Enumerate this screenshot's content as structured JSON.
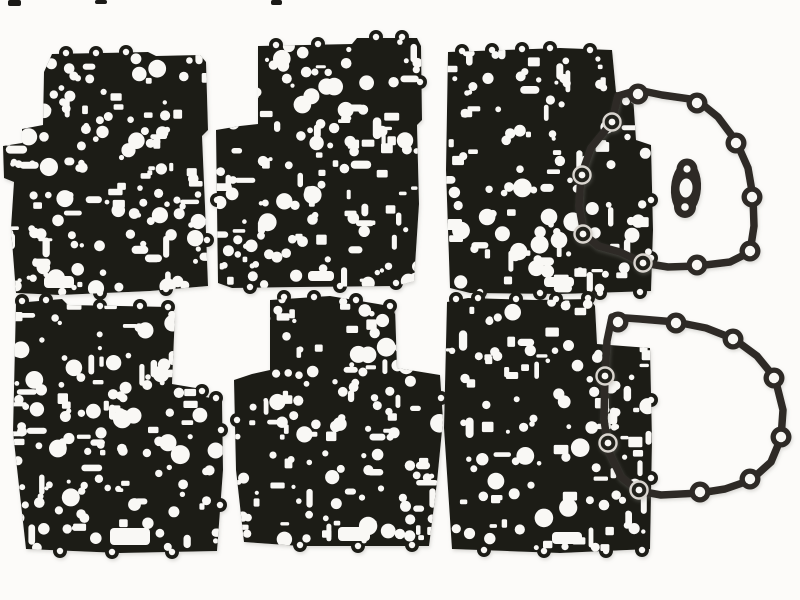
{
  "scene": {
    "background": "#fcfbf9",
    "plate_color": "#1b1a18",
    "hole_color": "#f9f8f5",
    "gasket_color": "#2e2b27",
    "ring_edge_color": "#d9d5cf",
    "ring_center_color": "#24211e",
    "plates": [
      {
        "name": "separator-plate-top-left",
        "outline": [
          [
            52,
            54
          ],
          [
            148,
            52
          ],
          [
            156,
            56
          ],
          [
            200,
            55
          ],
          [
            206,
            62
          ],
          [
            208,
            130
          ],
          [
            202,
            136
          ],
          [
            205,
            206
          ],
          [
            208,
            286
          ],
          [
            150,
            291
          ],
          [
            60,
            295
          ],
          [
            16,
            293
          ],
          [
            11,
            228
          ],
          [
            14,
            182
          ],
          [
            4,
            178
          ],
          [
            3,
            146
          ],
          [
            22,
            143
          ],
          [
            22,
            129
          ],
          [
            43,
            125
          ],
          [
            44,
            72
          ],
          [
            52,
            54
          ]
        ],
        "ears": [
          [
            66,
            53
          ],
          [
            96,
            53
          ],
          [
            126,
            52
          ],
          [
            14,
            162
          ],
          [
            100,
            293
          ],
          [
            166,
            289
          ],
          [
            207,
            240
          ]
        ],
        "slot": [
          44,
          276,
          30,
          12
        ],
        "hole_count": 150
      },
      {
        "name": "separator-plate-top-middle",
        "outline": [
          [
            258,
            46
          ],
          [
            352,
            44
          ],
          [
            357,
            38
          ],
          [
            417,
            38
          ],
          [
            421,
            46
          ],
          [
            422,
            120
          ],
          [
            417,
            125
          ],
          [
            419,
            204
          ],
          [
            414,
            281
          ],
          [
            396,
            286
          ],
          [
            300,
            287
          ],
          [
            232,
            288
          ],
          [
            218,
            283
          ],
          [
            216,
            130
          ],
          [
            240,
            126
          ],
          [
            258,
            124
          ],
          [
            258,
            46
          ]
        ],
        "ears": [
          [
            276,
            45
          ],
          [
            318,
            44
          ],
          [
            376,
            37
          ],
          [
            402,
            37
          ],
          [
            420,
            82
          ],
          [
            250,
            287
          ],
          [
            340,
            286
          ],
          [
            396,
            283
          ],
          [
            217,
            200
          ]
        ],
        "slot": [
          308,
          271,
          26,
          10
        ],
        "hole_count": 150
      },
      {
        "name": "separator-plate-top-right",
        "outline": [
          [
            448,
            52
          ],
          [
            560,
            48
          ],
          [
            612,
            50
          ],
          [
            616,
            92
          ],
          [
            633,
            95
          ],
          [
            636,
            140
          ],
          [
            651,
            145
          ],
          [
            653,
            230
          ],
          [
            651,
            291
          ],
          [
            560,
            294
          ],
          [
            470,
            293
          ],
          [
            450,
            288
          ],
          [
            446,
            170
          ],
          [
            448,
            52
          ]
        ],
        "ears": [
          [
            462,
            51
          ],
          [
            492,
            50
          ],
          [
            522,
            49
          ],
          [
            550,
            48
          ],
          [
            590,
            50
          ],
          [
            651,
            200
          ],
          [
            651,
            258
          ],
          [
            480,
            292
          ],
          [
            540,
            293
          ],
          [
            600,
            293
          ],
          [
            640,
            292
          ]
        ],
        "slot": [
          544,
          277,
          30,
          10
        ],
        "hole_count": 130
      },
      {
        "name": "separator-plate-bottom-left",
        "outline": [
          [
            16,
            303
          ],
          [
            62,
            299
          ],
          [
            68,
            305
          ],
          [
            170,
            307
          ],
          [
            175,
            313
          ],
          [
            172,
            384
          ],
          [
            196,
            388
          ],
          [
            200,
            396
          ],
          [
            222,
            400
          ],
          [
            223,
            470
          ],
          [
            217,
            551
          ],
          [
            120,
            553
          ],
          [
            26,
            549
          ],
          [
            13,
            432
          ],
          [
            16,
            303
          ]
        ],
        "ears": [
          [
            22,
            301
          ],
          [
            46,
            300
          ],
          [
            100,
            306
          ],
          [
            140,
            306
          ],
          [
            168,
            307
          ],
          [
            202,
            391
          ],
          [
            216,
            398
          ],
          [
            221,
            430
          ],
          [
            220,
            505
          ],
          [
            60,
            551
          ],
          [
            112,
            552
          ],
          [
            172,
            552
          ]
        ],
        "slot": [
          110,
          528,
          40,
          17
        ],
        "hole_count": 150
      },
      {
        "name": "separator-plate-bottom-middle",
        "outline": [
          [
            270,
            300
          ],
          [
            330,
            296
          ],
          [
            378,
            304
          ],
          [
            395,
            307
          ],
          [
            397,
            368
          ],
          [
            440,
            375
          ],
          [
            443,
            420
          ],
          [
            437,
            482
          ],
          [
            429,
            546
          ],
          [
            300,
            546
          ],
          [
            244,
            542
          ],
          [
            236,
            470
          ],
          [
            234,
            380
          ],
          [
            252,
            374
          ],
          [
            270,
            370
          ],
          [
            270,
            300
          ]
        ],
        "ears": [
          [
            284,
            297
          ],
          [
            314,
            297
          ],
          [
            356,
            300
          ],
          [
            390,
            306
          ],
          [
            441,
            398
          ],
          [
            300,
            545
          ],
          [
            358,
            546
          ],
          [
            412,
            545
          ],
          [
            237,
            420
          ]
        ],
        "slot": [
          338,
          527,
          32,
          14
        ],
        "hole_count": 150
      },
      {
        "name": "separator-plate-bottom-right",
        "outline": [
          [
            447,
            302
          ],
          [
            468,
            298
          ],
          [
            536,
            300
          ],
          [
            590,
            299
          ],
          [
            595,
            306
          ],
          [
            597,
            344
          ],
          [
            650,
            348
          ],
          [
            652,
            440
          ],
          [
            650,
            549
          ],
          [
            560,
            553
          ],
          [
            452,
            549
          ],
          [
            444,
            428
          ],
          [
            447,
            302
          ]
        ],
        "ears": [
          [
            456,
            299
          ],
          [
            478,
            298
          ],
          [
            516,
            299
          ],
          [
            556,
            299
          ],
          [
            588,
            298
          ],
          [
            651,
            400
          ],
          [
            651,
            478
          ],
          [
            484,
            550
          ],
          [
            544,
            551
          ],
          [
            606,
            551
          ],
          [
            642,
            550
          ]
        ],
        "slot": [
          552,
          532,
          30,
          12
        ],
        "hole_count": 130
      }
    ],
    "gaskets": [
      {
        "name": "case-cover-gasket-top-right",
        "stroke": 7.5,
        "loop": [
          [
            618,
            96
          ],
          [
            638,
            90
          ],
          [
            662,
            95
          ],
          [
            697,
            100
          ],
          [
            718,
            117
          ],
          [
            736,
            141
          ],
          [
            748,
            168
          ],
          [
            753,
            197
          ],
          [
            754,
            226
          ],
          [
            750,
            252
          ],
          [
            730,
            262
          ],
          [
            697,
            266
          ],
          [
            668,
            267
          ],
          [
            643,
            263
          ],
          [
            620,
            252
          ],
          [
            598,
            246
          ],
          [
            584,
            234
          ],
          [
            579,
            206
          ],
          [
            581,
            176
          ],
          [
            591,
            148
          ],
          [
            612,
            122
          ],
          [
            618,
            96
          ]
        ],
        "bolt_holes": [
          {
            "x": 638,
            "y": 94,
            "style": "solid"
          },
          {
            "x": 697,
            "y": 103,
            "style": "solid"
          },
          {
            "x": 736,
            "y": 143,
            "style": "solid"
          },
          {
            "x": 752,
            "y": 197,
            "style": "solid"
          },
          {
            "x": 750,
            "y": 251,
            "style": "solid"
          },
          {
            "x": 697,
            "y": 265,
            "style": "solid"
          },
          {
            "x": 612,
            "y": 122,
            "style": "ring"
          },
          {
            "x": 582,
            "y": 175,
            "style": "ring"
          },
          {
            "x": 583,
            "y": 234,
            "style": "ring"
          },
          {
            "x": 643,
            "y": 263,
            "style": "ring"
          }
        ]
      },
      {
        "name": "case-cover-gasket-bottom-right",
        "stroke": 7.5,
        "loop": [
          [
            612,
            317
          ],
          [
            640,
            319
          ],
          [
            676,
            322
          ],
          [
            706,
            328
          ],
          [
            734,
            339
          ],
          [
            757,
            356
          ],
          [
            775,
            378
          ],
          [
            783,
            410
          ],
          [
            781,
            438
          ],
          [
            771,
            462
          ],
          [
            751,
            480
          ],
          [
            725,
            489
          ],
          [
            700,
            493
          ],
          [
            661,
            495
          ],
          [
            639,
            491
          ],
          [
            621,
            477
          ],
          [
            609,
            452
          ],
          [
            604,
            420
          ],
          [
            605,
            376
          ],
          [
            607,
            341
          ],
          [
            612,
            317
          ]
        ],
        "bolt_holes": [
          {
            "x": 618,
            "y": 322,
            "style": "solid"
          },
          {
            "x": 676,
            "y": 323,
            "style": "solid"
          },
          {
            "x": 733,
            "y": 339,
            "style": "solid"
          },
          {
            "x": 774,
            "y": 378,
            "style": "solid"
          },
          {
            "x": 781,
            "y": 437,
            "style": "solid"
          },
          {
            "x": 750,
            "y": 479,
            "style": "solid"
          },
          {
            "x": 700,
            "y": 492,
            "style": "solid"
          },
          {
            "x": 605,
            "y": 376,
            "style": "ring"
          },
          {
            "x": 608,
            "y": 443,
            "style": "ring"
          },
          {
            "x": 639,
            "y": 490,
            "style": "ring"
          }
        ]
      }
    ],
    "oval_gasket": {
      "name": "oval-port-gasket",
      "cx": 686,
      "cy": 188,
      "rx": 15,
      "ry": 27,
      "tilt": 4,
      "center_hole": {
        "rx": 6.5,
        "ry": 9.5
      },
      "top_hole": [
        687,
        169
      ],
      "bottom_hole": [
        685,
        207
      ]
    },
    "fragments": [
      [
        8,
        0,
        13,
        6
      ],
      [
        95,
        0,
        12,
        4
      ],
      [
        271,
        0,
        11,
        5
      ]
    ]
  }
}
